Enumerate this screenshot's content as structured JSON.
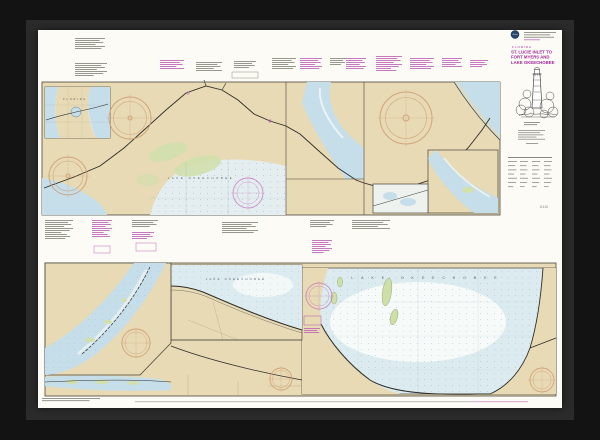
{
  "title_block": {
    "region": "FLORIDA",
    "title_lines": [
      "ST. LUCIE INLET TO",
      "FORT MYERS AND",
      "LAKE OKEECHOBEE"
    ],
    "chart_number": "11428"
  },
  "map_labels": {
    "florida_inset": "FLORIDA",
    "lake_okeechobee": "LAKE OKEECHOBEE"
  },
  "palette": {
    "frame": "#131313",
    "frame_lip": "#2b2b2b",
    "paper": "#fcfbf5",
    "land": "#e7dab4",
    "water": "#c6dee9",
    "water_pale": "#dcebef",
    "marsh_green": "#d2e0ae",
    "title_magenta": "#a1259c",
    "note_magenta": "#c06ab8",
    "note_gray": "#8c8c84",
    "compass_orange": "#cf9a72",
    "compass_magenta": "#c678c0",
    "line_black": "#2e2c28"
  }
}
